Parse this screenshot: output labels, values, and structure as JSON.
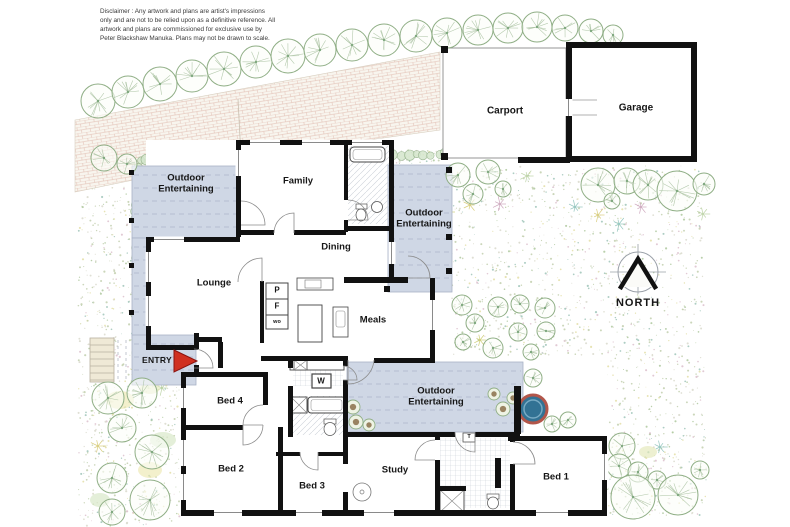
{
  "disclaimer": {
    "line1": "Disclaimer : Any artwork and plans are artist's impressions",
    "line2": "only and are not to be relied upon as a definitive reference. All",
    "line3": "artwork and plans are commissioned for exclusive use by",
    "line4": "Peter Blackshaw Manuka. Plans may not be drawn to scale."
  },
  "rooms": {
    "family": "Family",
    "dining": "Dining",
    "lounge": "Lounge",
    "meals": "Meals",
    "bed1": "Bed 1",
    "bed2": "Bed 2",
    "bed3": "Bed 3",
    "bed4": "Bed 4",
    "study": "Study",
    "carport": "Carport",
    "garage": "Garage"
  },
  "outdoor": {
    "top_left": "Outdoor Entertaining",
    "side": "Outdoor Entertaining",
    "rear": "Outdoor Entertaining"
  },
  "markers": {
    "entry": "ENTRY",
    "north": "NORTH"
  },
  "appliances": {
    "pantry": "P",
    "fridge": "F",
    "wall_oven": "wo",
    "washer": "W",
    "t_marker": "T"
  },
  "colors": {
    "wall": "#111111",
    "deck": "#cfd7e5",
    "deck_edge": "#a8b2c6",
    "deck_dash": "#95a0b8",
    "entry_arrow": "#d03020",
    "spa_water": "#327294",
    "spa_ring": "#b2564a",
    "tree_stroke": "#8fae85",
    "hedge_fill": "#d4e6cc"
  }
}
